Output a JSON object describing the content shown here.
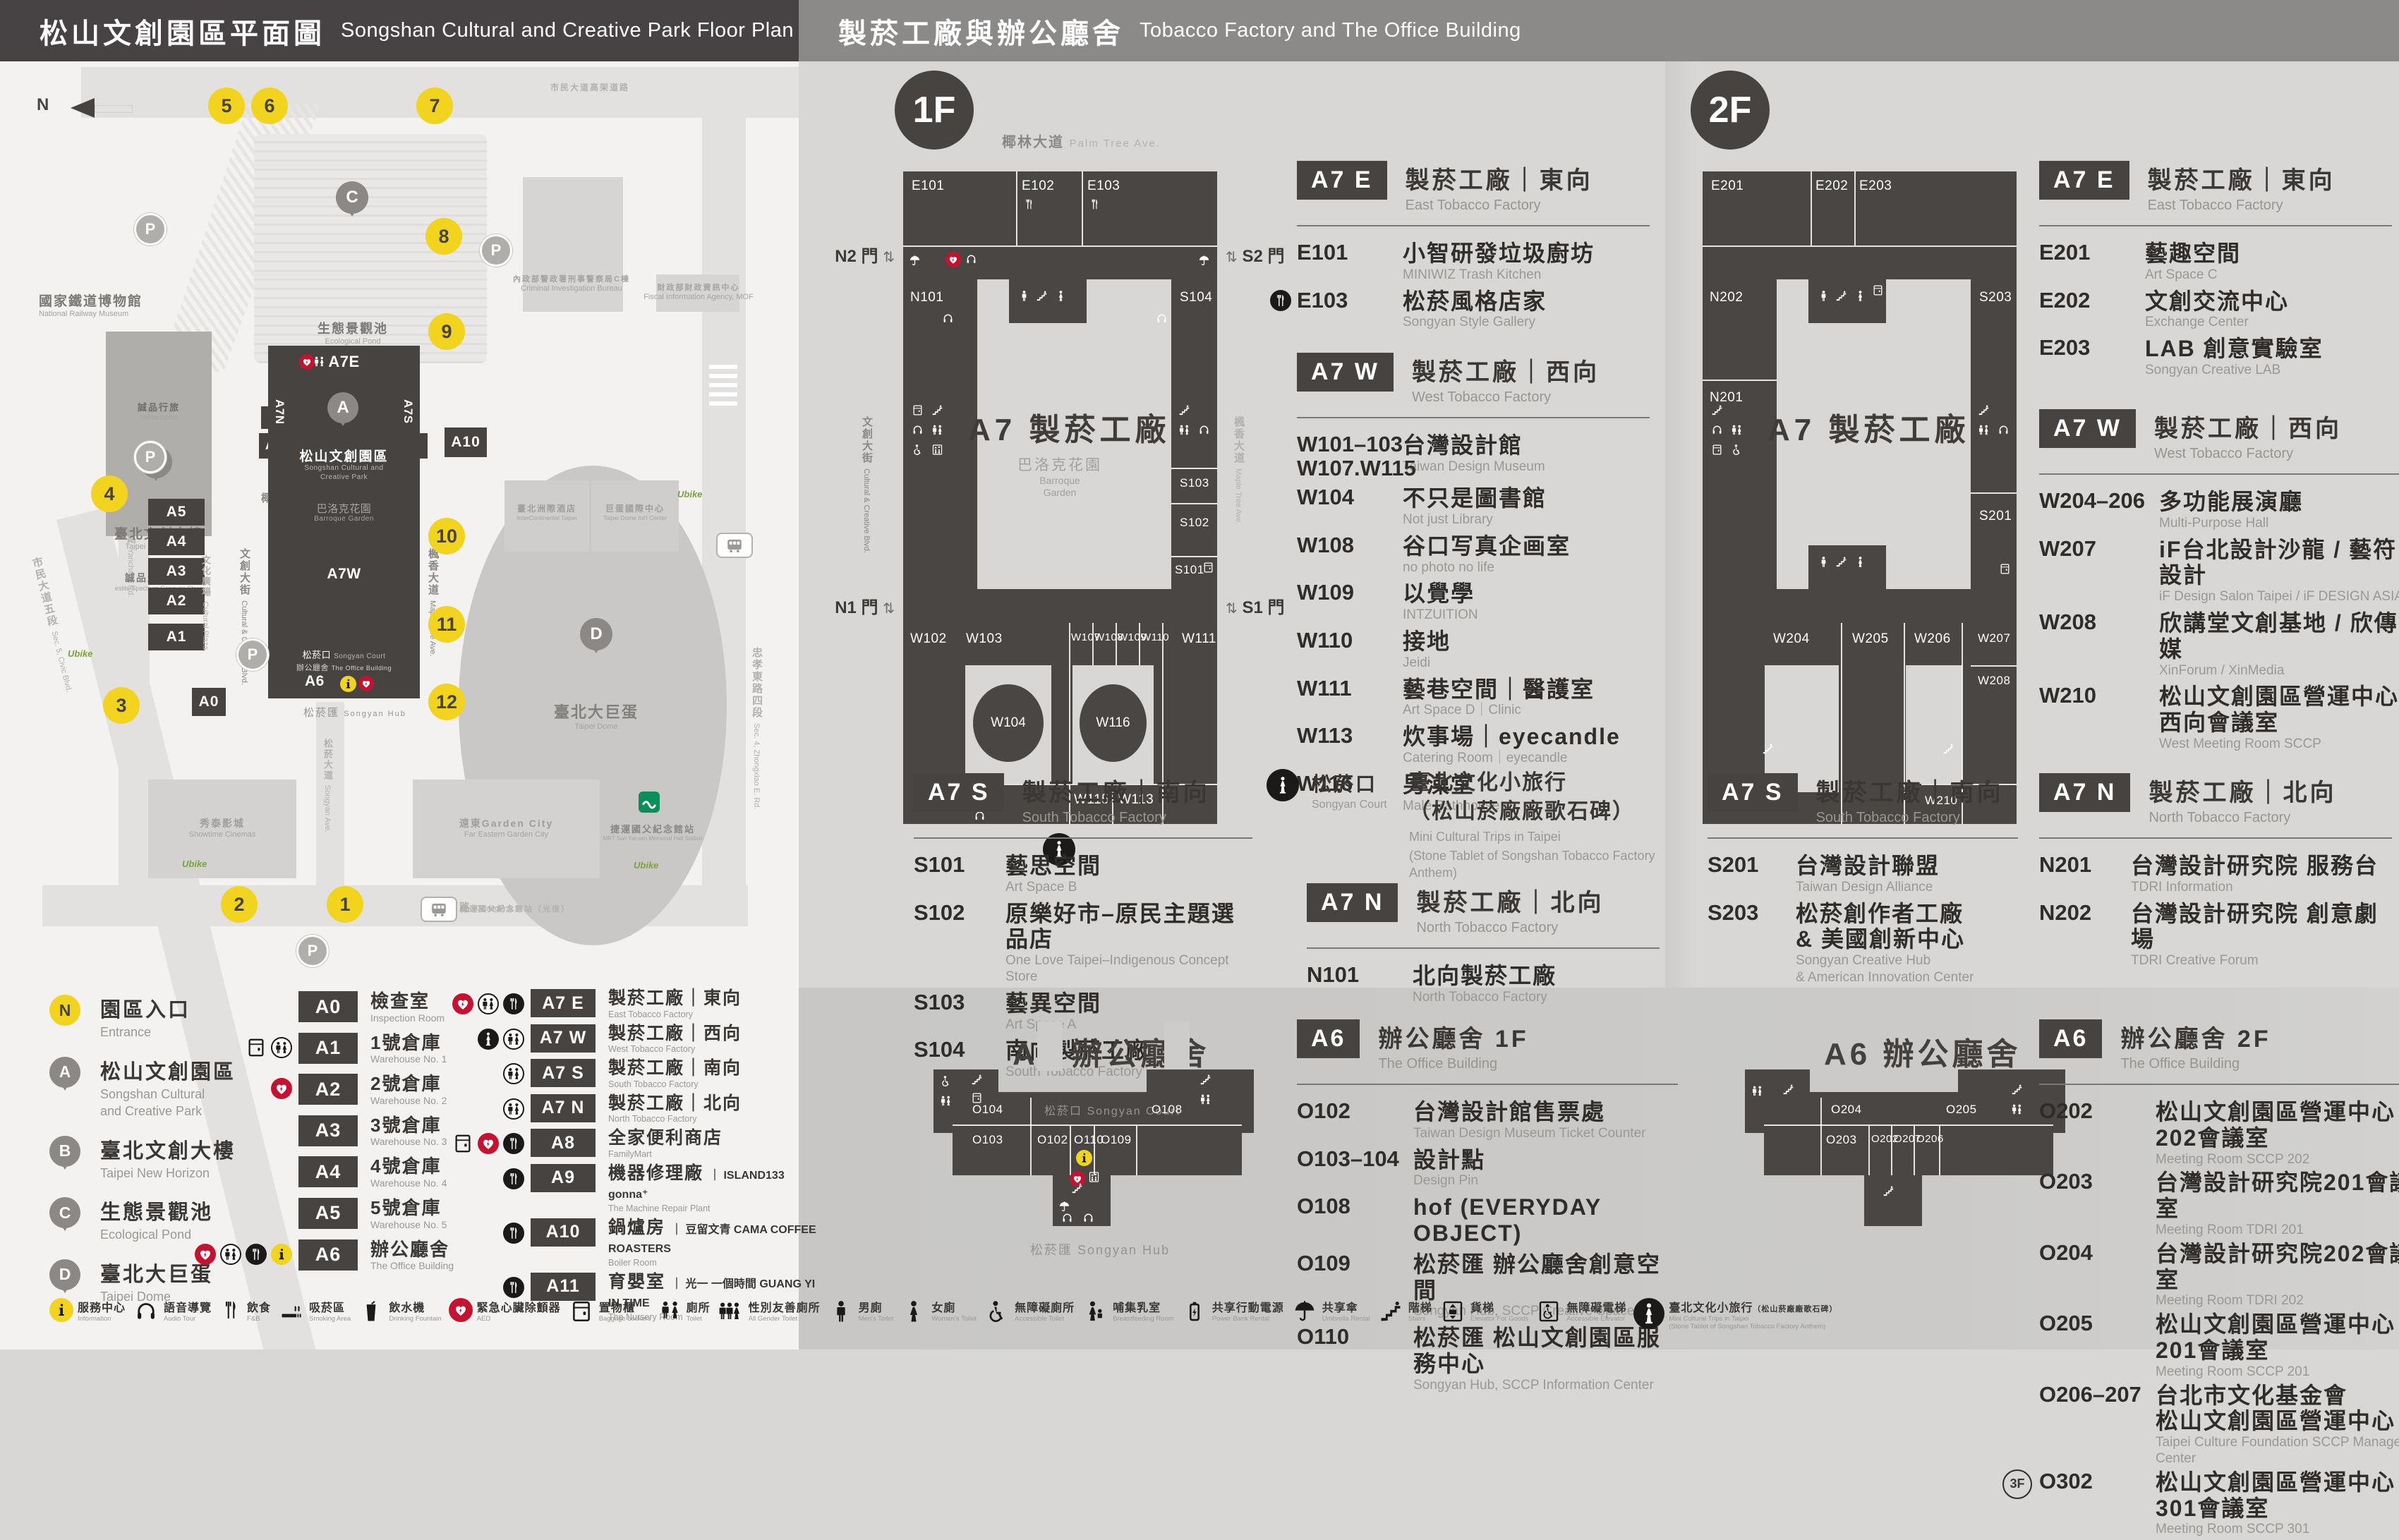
{
  "header": {
    "left_zh": "松山文創園區平面圖",
    "left_en": "Songshan Cultural and Creative Park Floor Plan",
    "right_zh": "製菸工廠與辦公廳舍",
    "right_en": "Tobacco Factory and The Office Building"
  },
  "map": {
    "north": "N",
    "parking": "P",
    "ubike": "Ubike",
    "roads": {
      "palm": {
        "zh": "椰林大道",
        "en": "Palm Tree Ave."
      },
      "cultural_blvd": {
        "zh": "文創大街",
        "en": "Cultural & Creative Blvd."
      },
      "cultural_plaza": {
        "zh": "文化廣場",
        "en": "Cultural Plaza"
      },
      "maple": {
        "zh": "楓香大道",
        "en": "Maple Tree Ave."
      },
      "yanchang": {
        "zh": "菸廠路",
        "en": "Yanchang Rd."
      },
      "civic": {
        "zh": "市民大道五段",
        "en": "Sec. 5, Civic Blvd."
      },
      "songyan": {
        "zh": "松菸大道",
        "en": "Songyan Ave."
      },
      "guangfu": {
        "zh": "光復南路",
        "en": "Guangfu S. Rd."
      },
      "zhongxiao": {
        "zh": "忠孝東路四段",
        "en": "Sec. 4, Zhongxiao E. Rd."
      },
      "elevated": {
        "zh": "市民大道高架道路",
        "en": ""
      }
    },
    "places": {
      "railway_museum": {
        "zh": "國家鐵道博物館",
        "en": "National Railway Museum"
      },
      "eslite_hotel": {
        "zh": "誠品行旅",
        "en": "eslite hotel"
      },
      "new_horizon": {
        "zh": "臺北文創大樓",
        "en": "Taipei New Horizon"
      },
      "eslite_store": {
        "zh": "誠品生活松菸",
        "en": "eslite Spectrum Songyan Store"
      },
      "pond": {
        "zh": "生態景觀池",
        "en": "Ecological Pond"
      },
      "cib": {
        "zh": "內政部警政署刑事警察局C棟",
        "en": "Criminal Investigation Bureau"
      },
      "fia": {
        "zh": "財政部財政資訊中心",
        "en": "Fiscal Information Agency, MOF"
      },
      "hotel": {
        "zh": "臺北洲際酒店",
        "en": "InterContinental Taipei"
      },
      "dome_center": {
        "zh": "巨蛋國際中心",
        "en": "Taipei Dome Int'l Center"
      },
      "dome": {
        "zh": "臺北大巨蛋",
        "en": "Taipei Dome"
      },
      "showtime": {
        "zh": "秀泰影城",
        "en": "Showtime Cinemas"
      },
      "garden_city": {
        "zh": "遠東Garden City",
        "en": "Far Eastern Garden City"
      },
      "mrt": {
        "zh": "捷運國父紀念館站",
        "en": "MRT Sun Yat-sen Memorial Hall Station"
      },
      "bus_stop": {
        "zh": "捷運國父紀念館站（光復）",
        "en": ""
      },
      "park": {
        "zh": "松山文創園區",
        "en1": "Songshan Cultural and",
        "en2": "Creative Park"
      },
      "baroque": {
        "zh": "巴洛克花園",
        "en": "Barroque Garden"
      },
      "court": {
        "zh": "松菸口",
        "en": "Songyan Court"
      },
      "office": {
        "zh": "辦公廳舍",
        "en": "The Office Building"
      },
      "hub": {
        "zh": "松菸匯",
        "en": "Songyan Hub"
      }
    },
    "bars": {
      "a0": "A0",
      "a1": "A1",
      "a2": "A2",
      "a3": "A3",
      "a4": "A4",
      "a5": "A5",
      "a6": "A6",
      "a7e": "A7E",
      "a7w": "A7W",
      "a7n": "A7N",
      "a7s": "A7S",
      "a8": "A8",
      "a9": "A9",
      "a10": "A10",
      "a11": "A11"
    },
    "pins": {
      "a": "A",
      "b": "B",
      "c": "C",
      "d": "D"
    },
    "entrances": [
      "1",
      "2",
      "3",
      "4",
      "5",
      "6",
      "7",
      "8",
      "9",
      "10",
      "11",
      "12"
    ]
  },
  "floor1": {
    "badge": "1F",
    "plan": {
      "center": "A7 製菸工廠",
      "garden_zh": "巴洛克花園",
      "garden_en1": "Barroque",
      "garden_en2": "Garden",
      "gates": {
        "n2": "N2 門",
        "s2": "S2 門",
        "n1": "N1 門",
        "s1": "S1 門"
      },
      "rooms": {
        "e101": "E101",
        "e102": "E102",
        "e103": "E103",
        "n101": "N101",
        "s104": "S104",
        "s103": "S103",
        "s102": "S102",
        "s101": "S101",
        "w102": "W102",
        "w103": "W103",
        "w104": "W104",
        "w101": "W101",
        "w107": "W107",
        "w108": "W108",
        "w109": "W109",
        "w110": "W110",
        "w116": "W116",
        "w115": "W115",
        "w113": "W113",
        "w111": "W111"
      }
    },
    "sections": [
      {
        "badge": "A7 E",
        "zh": "製菸工廠｜東向",
        "en": "East Tobacco Factory",
        "rooms": [
          {
            "code": "E101",
            "zh": "小智研發垃圾廚坊",
            "en": "MINIWIZ Trash Kitchen"
          },
          {
            "code": "E103",
            "icons": [
              "fnb"
            ],
            "zh": "松菸風格店家",
            "en": "Songyan Style Gallery"
          }
        ]
      },
      {
        "badge": "A7 W",
        "zh": "製菸工廠｜西向",
        "en": "West Tobacco Factory",
        "rooms": [
          {
            "code": "W101–103",
            "code2": "W107.W115",
            "zh": "台灣設計館",
            "en": "Taiwan Design Museum"
          },
          {
            "code": "W104",
            "zh": "不只是圖書館",
            "en": "Not just Library"
          },
          {
            "code": "W108",
            "zh": "谷口写真企画室",
            "en": "no photo no life"
          },
          {
            "code": "W109",
            "zh": "以覺學",
            "en": "INTZUITION"
          },
          {
            "code": "W110",
            "zh": "接地",
            "en": "Jeidi"
          },
          {
            "code": "W111",
            "zh": "藝巷空間｜醫護室",
            "en": "Art Space D｜Clinic"
          },
          {
            "code": "W113",
            "zh": "炊事場｜eyecandle",
            "en": "Catering Room｜eyecandle"
          },
          {
            "code": "W116",
            "zh": "男澡堂",
            "en": "Male Bathhouse"
          }
        ]
      },
      {
        "badge": "A7 S",
        "zh": "製菸工廠｜南向",
        "en": "South Tobacco Factory",
        "rooms": [
          {
            "code": "S101",
            "zh": "藝思空間",
            "en": "Art Space B"
          },
          {
            "code": "S102",
            "zh": "原樂好市–原民主題選品店",
            "en": "One Love Taipei–Indigenous Concept Store"
          },
          {
            "code": "S103",
            "zh": "藝異空間",
            "en": "Art Space A"
          },
          {
            "code": "S104",
            "zh": "南向製菸工廠",
            "en": "South Tobacco Factory"
          }
        ]
      },
      {
        "badge": "A7 N",
        "zh": "製菸工廠｜北向",
        "en": "North Tobacco Factory",
        "rooms": [
          {
            "code": "N101",
            "zh": "北向製菸工廠",
            "en": "North Tobacco Factory"
          }
        ]
      }
    ],
    "court": {
      "zh": "松菸口",
      "en": "Songyan Court",
      "line1": "臺北文化小旅行",
      "line2": "（松山菸廠廠歌石碑）",
      "en1": "Mini Cultural Trips in Taipei",
      "en2": "(Stone Tablet of Songshan Tobacco Factory Anthem)"
    }
  },
  "a6_floor1": {
    "plan_title": "A6 辦公廳舍",
    "court_lbl": "松菸口 Songyan Court",
    "hub_lbl": "松菸匯 Songyan Hub",
    "rooms": {
      "o104": "O104",
      "o103": "O103",
      "o102": "O102",
      "o110": "O110",
      "o109": "O109",
      "o108": "O108"
    },
    "badge": "A6",
    "zh": "辦公廳舍 1F",
    "en": "The Office Building",
    "list": [
      {
        "code": "O102",
        "zh": "台灣設計館售票處",
        "en": "Taiwan Design Museum Ticket Counter"
      },
      {
        "code": "O103–104",
        "zh": "設計點",
        "en": "Design Pin"
      },
      {
        "code": "O108",
        "zh": "hof (EVERYDAY OBJECT)"
      },
      {
        "code": "O109",
        "zh": "松菸匯 辦公廳舍創意空間",
        "en": "Songyan Hub, SCCP Creative Space"
      },
      {
        "code": "O110",
        "zh": "松菸匯 松山文創園區服務中心",
        "en": "Songyan Hub, SCCP Information Center"
      }
    ]
  },
  "floor2": {
    "badge": "2F",
    "plan": {
      "center": "A7 製菸工廠",
      "rooms": {
        "e201": "E201",
        "e202": "E202",
        "e203": "E203",
        "n202": "N202",
        "n201": "N201",
        "s203": "S203",
        "s201": "S201",
        "w204": "W204",
        "w205": "W205",
        "w206": "W206",
        "w207": "W207",
        "w208": "W208",
        "w210": "W210"
      }
    },
    "sections": [
      {
        "badge": "A7 E",
        "zh": "製菸工廠｜東向",
        "en": "East Tobacco Factory",
        "rooms": [
          {
            "code": "E201",
            "zh": "藝趣空間",
            "en": "Art Space C"
          },
          {
            "code": "E202",
            "zh": "文創交流中心",
            "en": "Exchange Center"
          },
          {
            "code": "E203",
            "zh": "LAB 創意實驗室",
            "en": "Songyan Creative LAB"
          }
        ]
      },
      {
        "badge": "A7 W",
        "zh": "製菸工廠｜西向",
        "en": "West Tobacco Factory",
        "rooms": [
          {
            "code": "W204–206",
            "zh": "多功能展演廳",
            "en": "Multi-Purpose Hall"
          },
          {
            "code": "W207",
            "zh": "iF台北設計沙龍 / 藝符設計",
            "en": "iF Design Salon Taipei / iF DESIGN ASIA"
          },
          {
            "code": "W208",
            "zh": "欣講堂文創基地 / 欣傳媒",
            "en": "XinForum / XinMedia"
          },
          {
            "code": "W210",
            "zh": "松山文創園區營運中心",
            "zh2": "西向會議室",
            "en": "West Meeting Room SCCP"
          }
        ]
      },
      {
        "badge": "A7 S",
        "zh": "製菸工廠｜南向",
        "en": "South Tobacco Factory",
        "rooms": [
          {
            "code": "S201",
            "zh": "台灣設計聯盟",
            "en": "Taiwan Design Alliance"
          },
          {
            "code": "S203",
            "zh": "松菸創作者工廠",
            "zh2": "& 美國創新中心",
            "en": "Songyan Creative Hub",
            "en2": "& American Innovation Center"
          }
        ]
      },
      {
        "badge": "A7 N",
        "zh": "製菸工廠｜北向",
        "en": "North Tobacco Factory",
        "rooms": [
          {
            "code": "N201",
            "zh": "台灣設計研究院 服務台",
            "en": "TDRI Information"
          },
          {
            "code": "N202",
            "zh": "台灣設計研究院 創意劇場",
            "en": "TDRI Creative Forum"
          }
        ]
      }
    ]
  },
  "a6_floor2": {
    "plan_title": "A6 辦公廳舍",
    "rooms": {
      "o204": "O204",
      "o203": "O203",
      "o202": "O202",
      "o207": "O207",
      "o206": "O206",
      "o205": "O205"
    },
    "badge": "A6",
    "zh": "辦公廳舍 2F",
    "en": "The Office Building",
    "list": [
      {
        "code": "O202",
        "zh": "松山文創園區營運中心202會議室",
        "en": "Meeting Room SCCP 202"
      },
      {
        "code": "O203",
        "zh": "台灣設計研究院201會議室",
        "en": "Meeting Room TDRI 201"
      },
      {
        "code": "O204",
        "zh": "台灣設計研究院202會議室",
        "en": "Meeting Room TDRI 202"
      },
      {
        "code": "O205",
        "zh": "松山文創園區營運中心201會議室",
        "en": "Meeting Room SCCP 201"
      },
      {
        "code": "O206–207",
        "zh": "台北市文化基金會",
        "zh2": "松山文創園區營運中心",
        "en": "Taipei Culture Foundation SCCP Management Center"
      },
      {
        "code": "O302",
        "pre": "3F",
        "zh": "松山文創園區營運中心301會議室",
        "en": "Meeting Room SCCP 301"
      }
    ]
  },
  "legend": {
    "pins": [
      {
        "label": "N",
        "kind": "entrance",
        "zh": "園區入口",
        "en": "Entrance"
      },
      {
        "label": "A",
        "zh": "松山文創園區",
        "en": "Songshan Cultural",
        "en2": "and Creative Park"
      },
      {
        "label": "B",
        "zh": "臺北文創大樓",
        "en": "Taipei New Horizon"
      },
      {
        "label": "C",
        "zh": "生態景觀池",
        "en": "Ecological Pond"
      },
      {
        "label": "D",
        "zh": "臺北大巨蛋",
        "en": "Taipei Dome"
      }
    ],
    "row_a": [
      {
        "code": "A0",
        "zh": "檢查室",
        "en": "Inspection Room",
        "icons": []
      },
      {
        "code": "A1",
        "zh": "1號倉庫",
        "en": "Warehouse No. 1",
        "icons": [
          "locker",
          "toilet"
        ]
      },
      {
        "code": "A2",
        "zh": "2號倉庫",
        "en": "Warehouse No. 2",
        "icons": [
          "aed"
        ]
      },
      {
        "code": "A3",
        "zh": "3號倉庫",
        "en": "Warehouse No. 3",
        "icons": []
      },
      {
        "code": "A4",
        "zh": "4號倉庫",
        "en": "Warehouse No. 4",
        "icons": []
      },
      {
        "code": "A5",
        "zh": "5號倉庫",
        "en": "Warehouse No. 5",
        "icons": []
      },
      {
        "code": "A6",
        "zh": "辦公廳舍",
        "en": "The Office Building",
        "icons": [
          "aed",
          "toilet",
          "fnb",
          "info"
        ]
      }
    ],
    "row_b": [
      {
        "code": "A7 E",
        "zh": "製菸工廠｜東向",
        "en": "East Tobacco Factory",
        "icons": [
          "aed",
          "toilet",
          "fnb"
        ]
      },
      {
        "code": "A7 W",
        "zh": "製菸工廠｜西向",
        "en": "West Tobacco Factory",
        "icons": [
          "statue",
          "toilet"
        ]
      },
      {
        "code": "A7 S",
        "zh": "製菸工廠｜南向",
        "en": "South Tobacco Factory",
        "icons": [
          "toilet"
        ]
      },
      {
        "code": "A7 N",
        "zh": "製菸工廠｜北向",
        "en": "North Tobacco Factory",
        "icons": [
          "toilet"
        ]
      },
      {
        "code": "A8",
        "zh": "全家便利商店",
        "en": "FamilyMart",
        "icons": [
          "locker",
          "aed",
          "fnb"
        ]
      },
      {
        "code": "A9",
        "zh": "機器修理廠",
        "sub": "｜ ISLAND133 gonna⁺",
        "en": "The Machine Repair Plant",
        "icons": [
          "fnb"
        ]
      },
      {
        "code": "A10",
        "zh": "鍋爐房",
        "sub": "｜ 豆留文青 CAMA COFFEE ROASTERS",
        "en": "Boiler Room",
        "icons": [
          "fnb"
        ]
      },
      {
        "code": "A11",
        "zh": "育嬰室",
        "sub": "｜ 光一 一個時間 GUANG YI IN TIME",
        "en": "The Nursery Room",
        "icons": [
          "fnb"
        ]
      }
    ]
  },
  "facilities": [
    {
      "icons": [
        "info"
      ],
      "zh": "服務中心",
      "en": "Information"
    },
    {
      "icons": [
        "audio"
      ],
      "zh": "語音導覽",
      "en": "Audio Tour"
    },
    {
      "icons": [
        "fnb"
      ],
      "zh": "飲食",
      "en": "F&B"
    },
    {
      "icons": [
        "smoking"
      ],
      "zh": "吸菸區",
      "en": "Smoking Area"
    },
    {
      "icons": [
        "water"
      ],
      "zh": "飲水機",
      "en": "Drinking Fountain"
    },
    {
      "icons": [
        "aed"
      ],
      "zh": "緊急心臟除顫器",
      "en": "AED"
    },
    {
      "icons": [
        "locker"
      ],
      "zh": "置物櫃",
      "en": "Baggage Lockers"
    },
    {
      "icons": [
        "toilet"
      ],
      "zh": "廁所",
      "en": "Toilet"
    },
    {
      "icons": [
        "allgender"
      ],
      "zh": "性別友善廁所",
      "en": "All Gender Toilet"
    },
    {
      "icons": [
        "men"
      ],
      "zh": "男廁",
      "en": "Men's Toilet"
    },
    {
      "icons": [
        "women"
      ],
      "zh": "女廁",
      "en": "Women's Toilet"
    },
    {
      "icons": [
        "accessible"
      ],
      "zh": "無障礙廁所",
      "en": "Accessible Toilet"
    },
    {
      "icons": [
        "nursing"
      ],
      "zh": "哺集乳室",
      "en": "Breastfeeding Room"
    },
    {
      "icons": [
        "powerbank"
      ],
      "zh": "共享行動電源",
      "en": "Power Bank Rental"
    },
    {
      "icons": [
        "umbrella"
      ],
      "zh": "共享傘",
      "en": "Umbrella Rental"
    },
    {
      "icons": [
        "stairs"
      ],
      "zh": "階梯",
      "en": "Stairs"
    },
    {
      "icons": [
        "goods_elevator"
      ],
      "zh": "貨梯",
      "en": "Elevator For Goods"
    },
    {
      "icons": [
        "accessible_elevator"
      ],
      "zh": "無障礙電梯",
      "en": "Accessible Elevator"
    },
    {
      "icons": [
        "trips"
      ],
      "zh": "臺北文化小旅行",
      "zh2": "（松山菸廠廠歌石碑）",
      "en": "Mini Cultural Trips in Taipei",
      "en2": "(Stone Tablet of Songshan Tobacco Factory Anthem)"
    }
  ]
}
